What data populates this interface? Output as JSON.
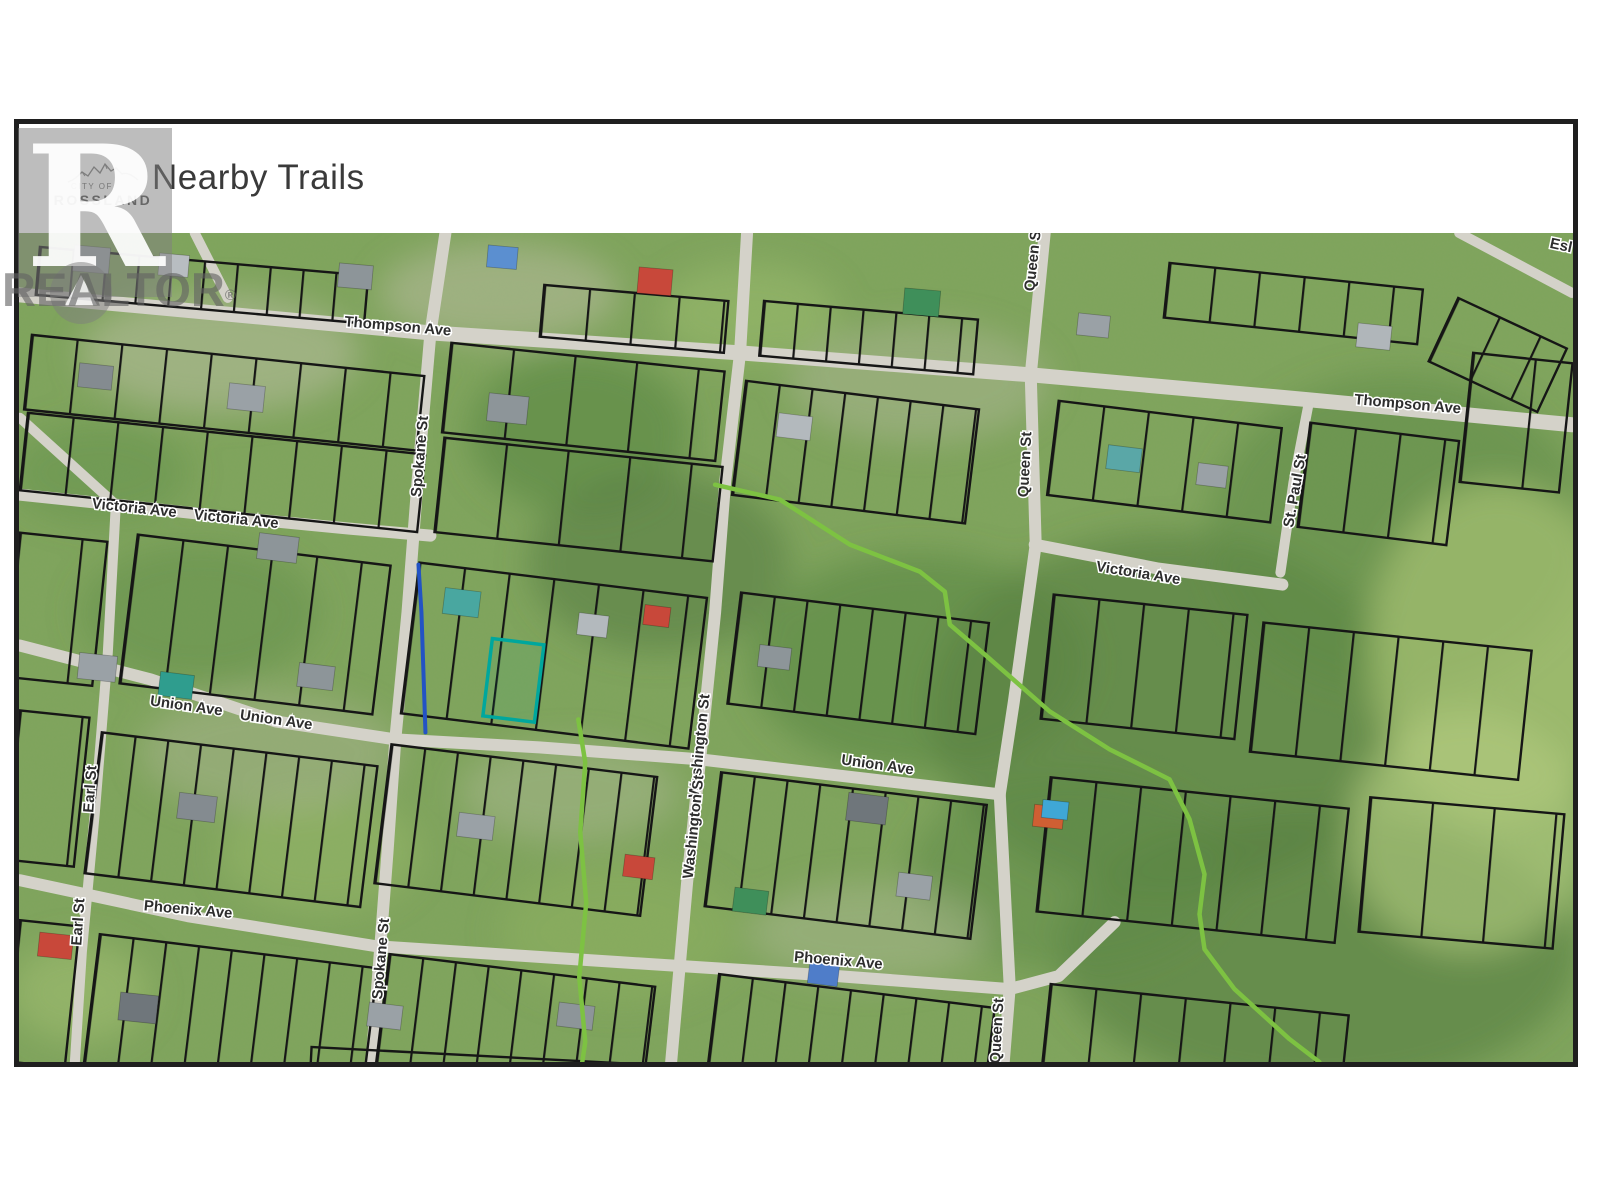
{
  "header": {
    "title": "Nearby Trails",
    "logo_city": "CITY OF",
    "logo_name": "ROSSLAND"
  },
  "watermark": {
    "big_letter": "R",
    "wordmark": "REALTOR",
    "registered": "®"
  },
  "map": {
    "labels": [
      "Thompson Ave",
      "Thompson Ave",
      "Victoria Ave",
      "Victoria Ave",
      "Victoria Ave",
      "Spokane St",
      "Spokane St",
      "Washington St",
      "Washington St",
      "Union Ave",
      "Union Ave",
      "Union Ave",
      "Phoenix Ave",
      "Phoenix Ave",
      "Earl St",
      "Earl St",
      "Queen St",
      "Queen St",
      "Queen St",
      "St. Paul St",
      "Esl"
    ],
    "subject_parcel_outline_color": "#00a79d",
    "trail_color": "#7dc242",
    "water_line_color": "#2353c4",
    "road_color": "#d4d2c9",
    "parcel_line_color": "#161616"
  }
}
